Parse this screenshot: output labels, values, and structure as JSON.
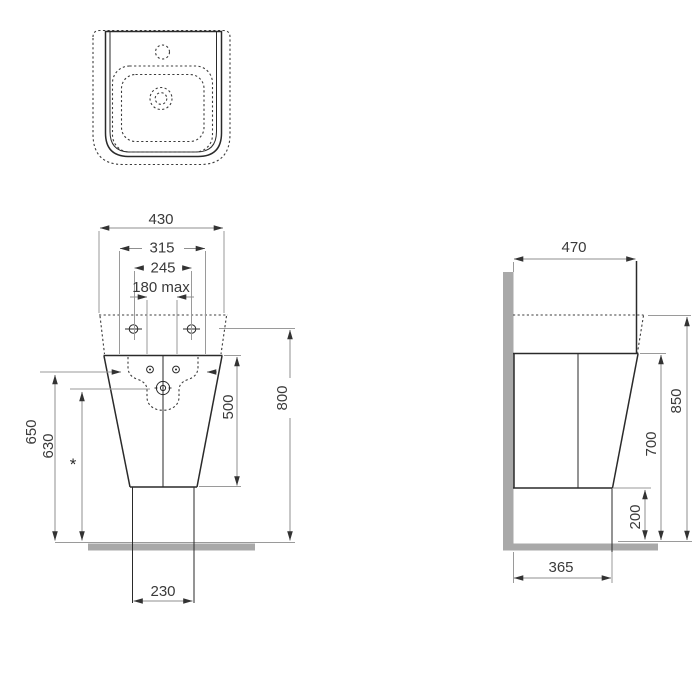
{
  "drawing": {
    "title": "washbasin-technical-drawing",
    "front": {
      "dim_overall_width": "430",
      "dim_rim_width": "315",
      "dim_fixing_spacing": "245",
      "dim_tap_spacing": "180 max",
      "dim_height_outer": "650",
      "dim_height_inner": "630",
      "dim_body_height": "500",
      "dim_overall_height": "800",
      "dim_outlet_width": "230",
      "note_marker": "*"
    },
    "side": {
      "dim_depth": "470",
      "dim_overall_height": "850",
      "dim_underside_height": "700",
      "dim_clearance": "200",
      "dim_base_depth": "365"
    },
    "colors": {
      "object_line": "#2a2a2a",
      "hidden_line": "#3c3c3c",
      "dimension_line": "#8f8f8f",
      "wall_floor_fill": "#a9a9a9",
      "label_text": "#3a3a3a",
      "background": "#ffffff"
    }
  }
}
